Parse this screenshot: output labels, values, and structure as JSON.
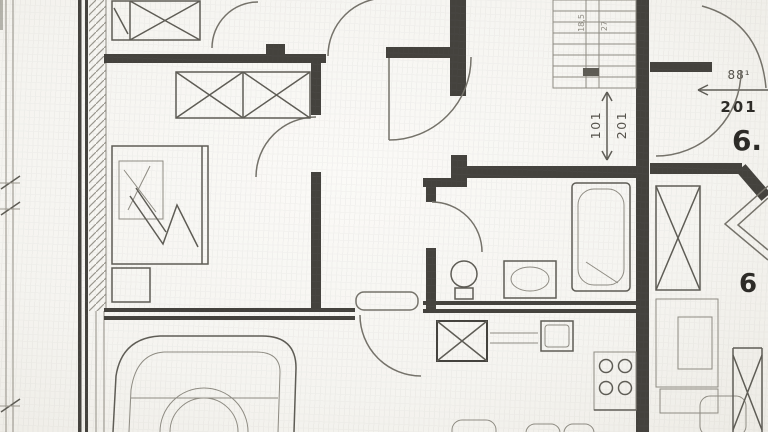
{
  "labels": {
    "stair_note_a": "18,5",
    "stair_note_b": "27",
    "stair_door_width": "101",
    "stair_door_height": "201",
    "entry_door_width": "88¹",
    "entry_door_height": "201",
    "unit_number_top": "6.",
    "unit_number_bottom": "6"
  },
  "colors": {
    "paper": "#f5f4f0",
    "ink_dark": "#2e2c28",
    "ink_mid": "#55524b",
    "ink_light": "#8f8c83"
  }
}
